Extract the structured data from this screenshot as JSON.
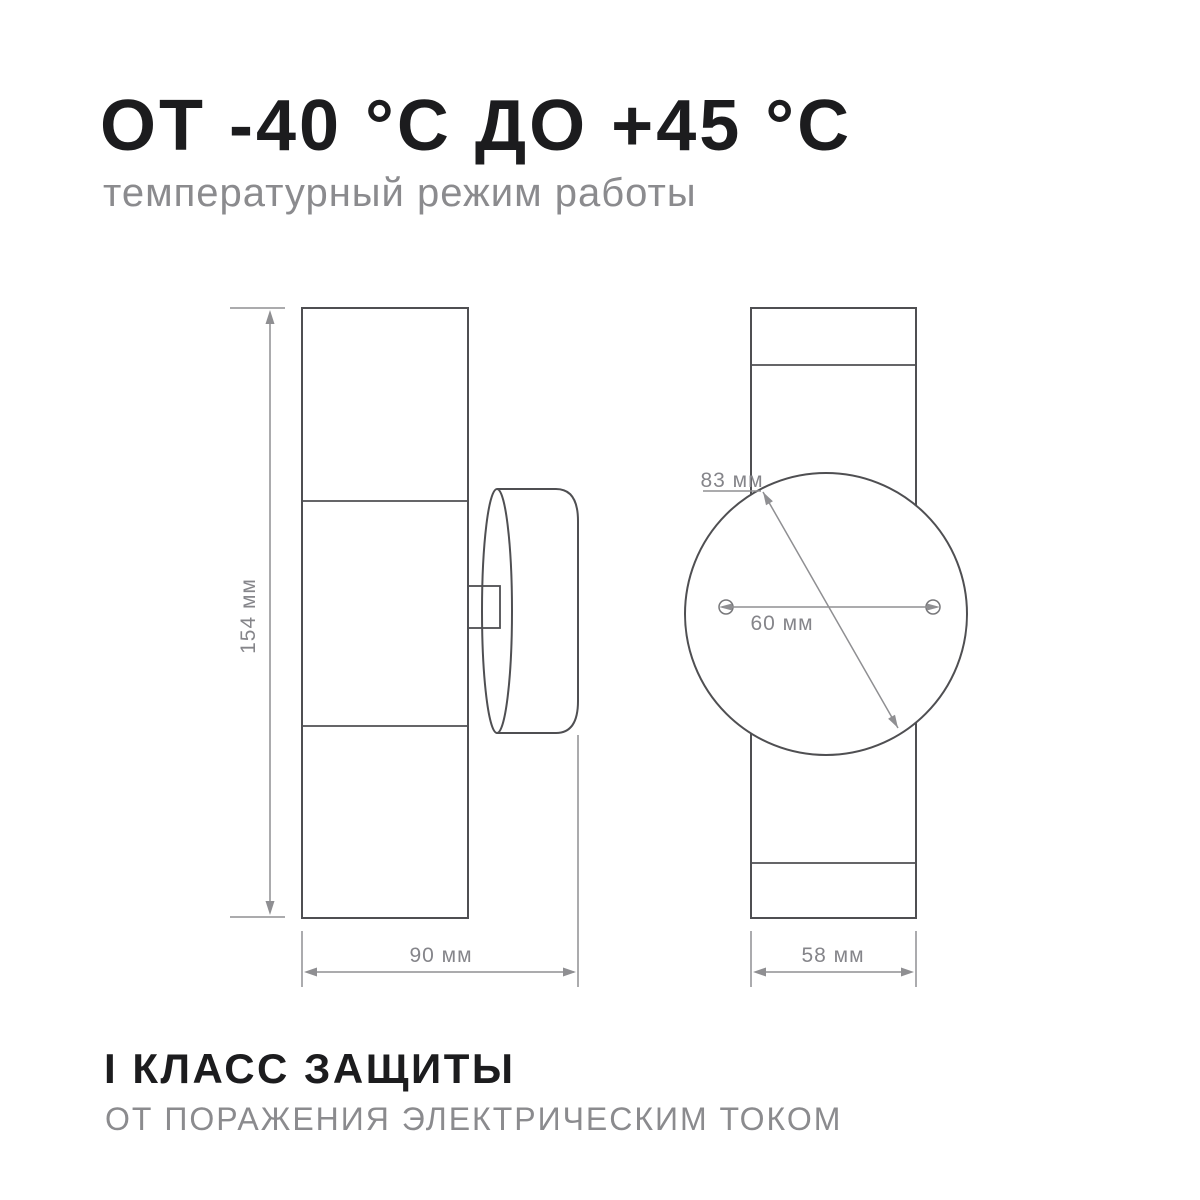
{
  "header": {
    "title": "ОТ -40 °С ДО +45 °С",
    "subtitle": "температурный режим работы"
  },
  "footer": {
    "title": "I КЛАСС ЗАЩИТЫ",
    "subtitle": "ОТ ПОРАЖЕНИЯ ЭЛЕКТРИЧЕСКИМ ТОКОМ"
  },
  "diagram": {
    "side_view": {
      "description": "wall lamp cylinder side view with mounting plate",
      "height_label": "154 мм",
      "width_label": "90 мм"
    },
    "front_view": {
      "description": "lamp rear view with round mounting plate and screw holes",
      "diameter_label": "83 мм",
      "hole_spacing_label": "60 мм",
      "width_label": "58 мм"
    }
  },
  "colors": {
    "background": "#ffffff",
    "title_text": "#1c1c1e",
    "subtitle_text": "#8b8b8e",
    "outline": "#4f4f52",
    "dimension_lines": "#8f8f92",
    "dimension_text": "#85858a"
  }
}
